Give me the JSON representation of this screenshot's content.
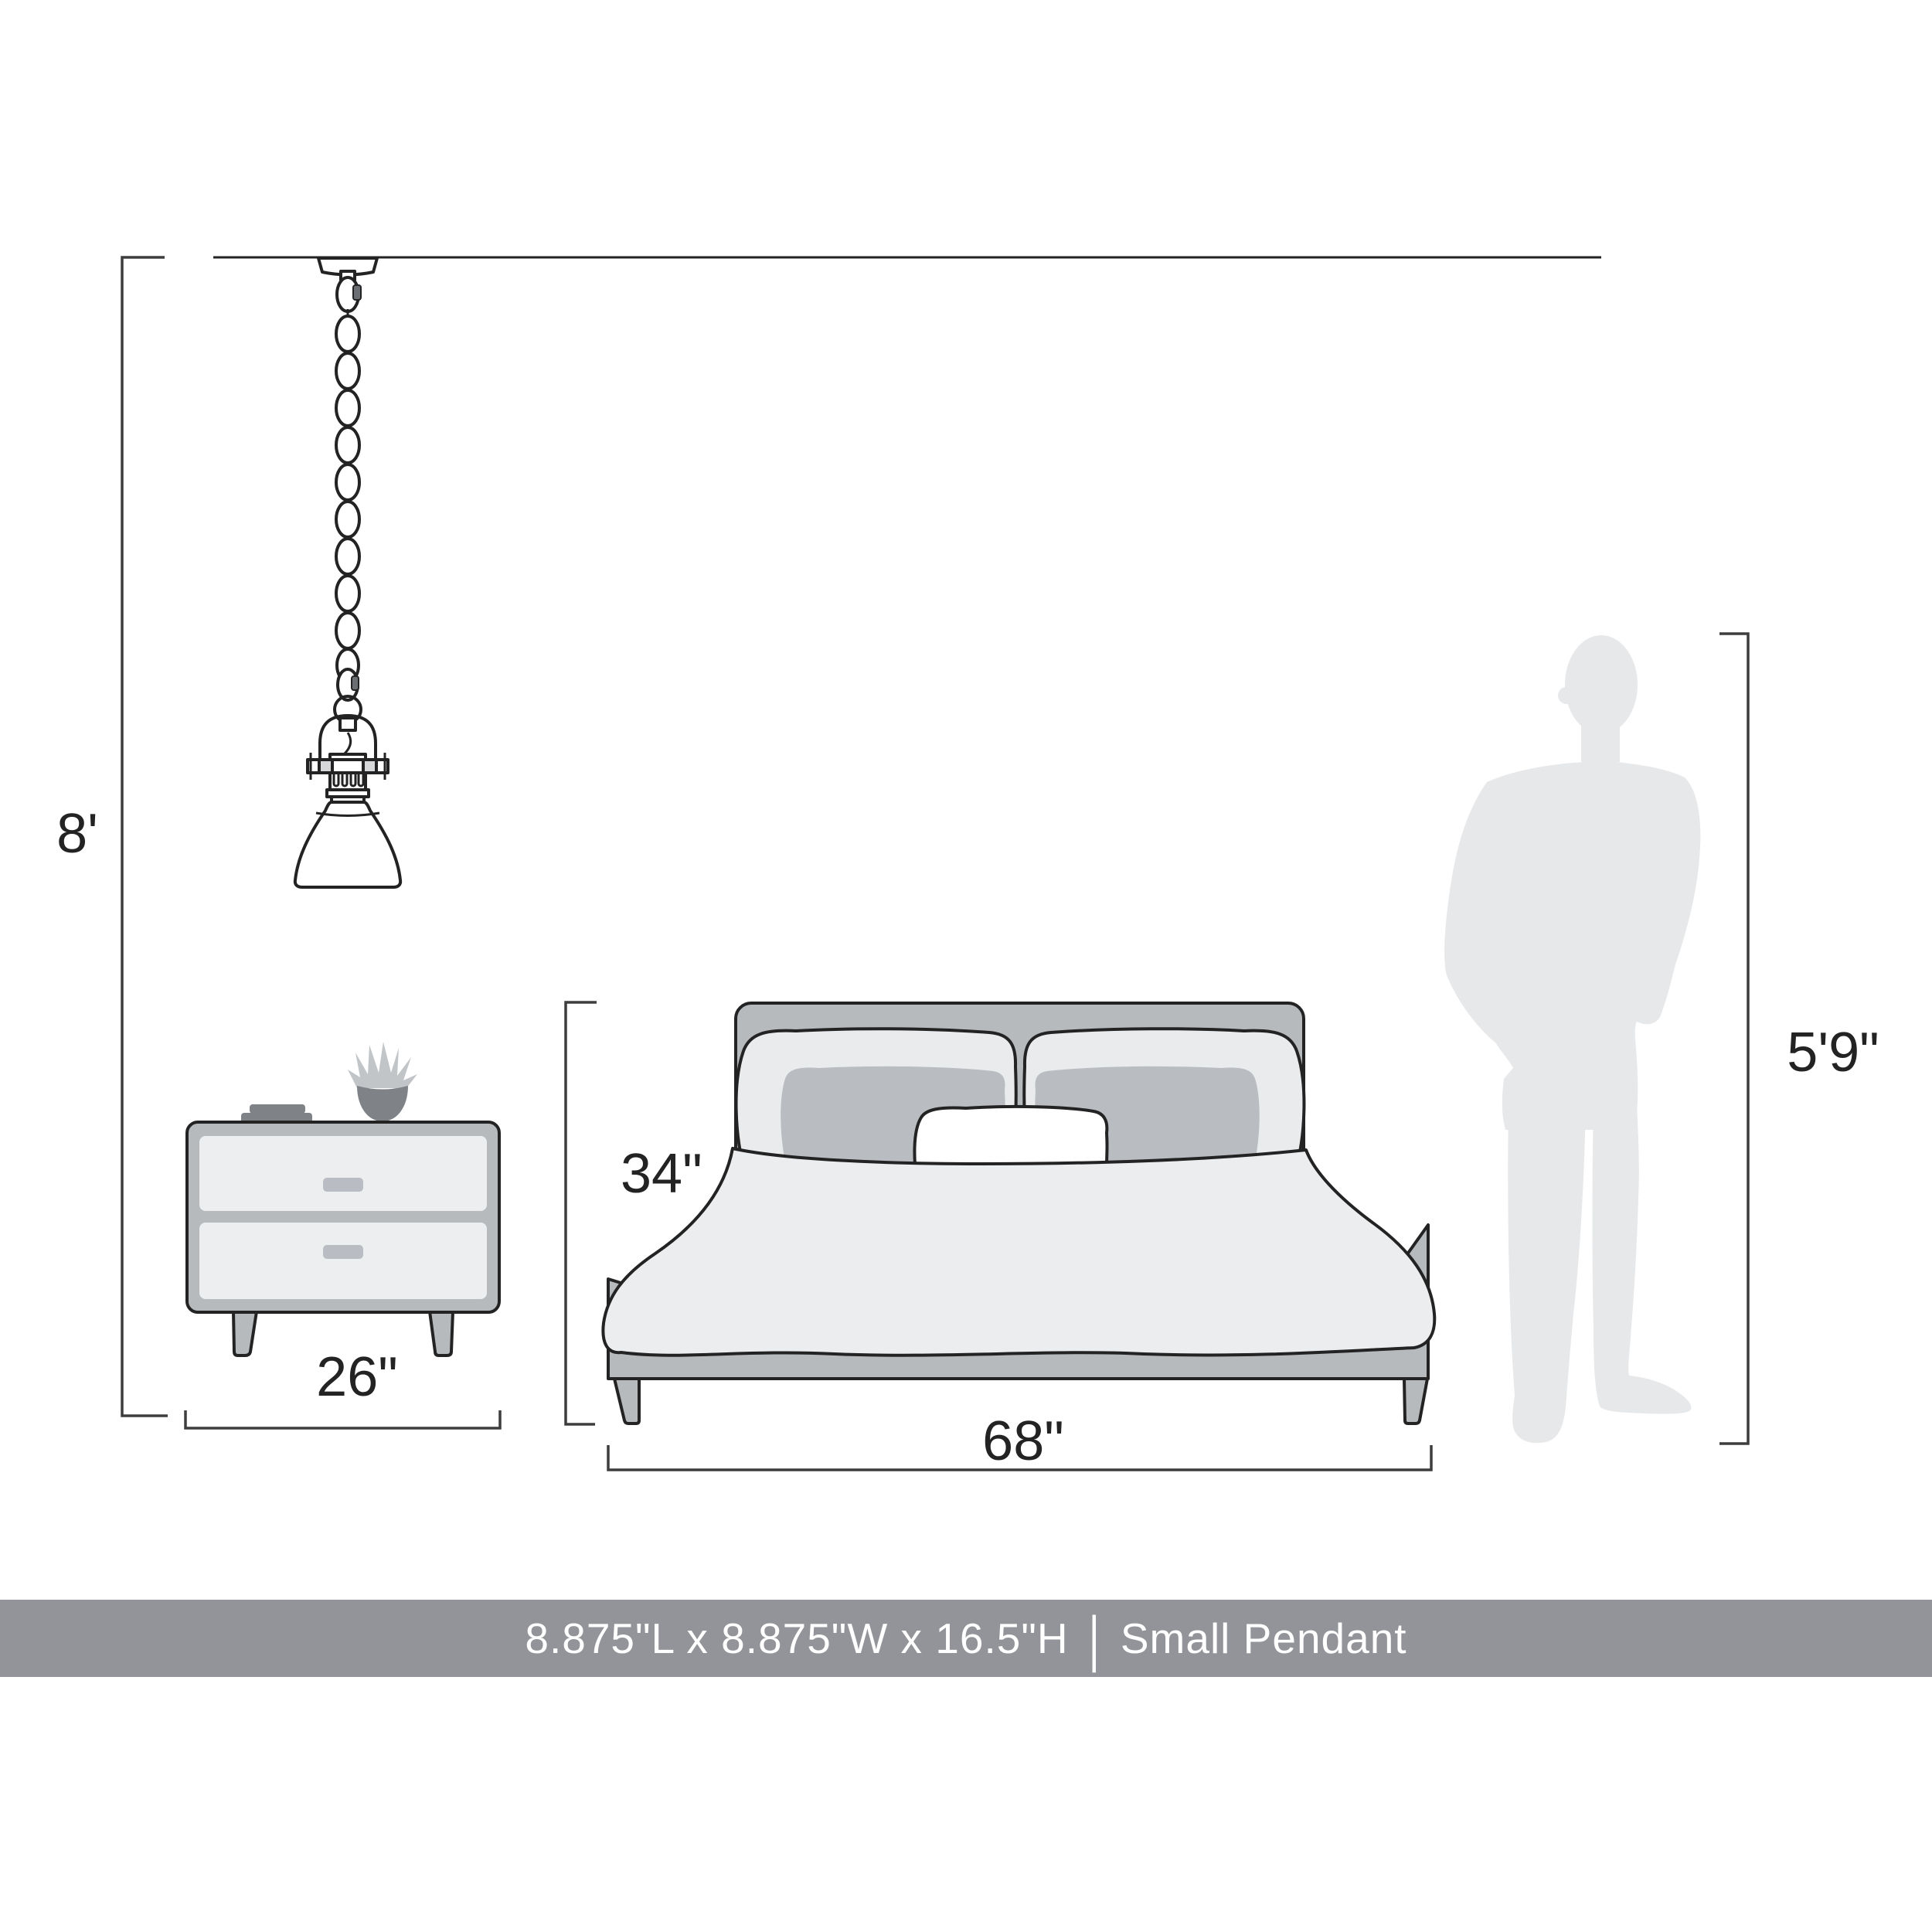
{
  "labels": {
    "ceiling_height": "8'",
    "nightstand_width": "26\"",
    "bed_height": "34\"",
    "bed_width": "68\"",
    "person_height": "5'9\""
  },
  "banner": {
    "dimensions": "8.875\"L x 8.875\"W x 16.5\"H",
    "divider": "|",
    "product_name": "Small Pendant"
  },
  "icons": {
    "pendant": "pendant-light-line-drawing",
    "nightstand": "nightstand-line-drawing",
    "bed": "bed-line-drawing",
    "person": "standing-man-silhouette"
  },
  "colors": {
    "background": "#ffffff",
    "line": "#232323",
    "dim_line": "#3d3d3d",
    "furniture_gray": "#b7babd",
    "panel_light": "#edeef0",
    "pillow_back": "#e9ebed",
    "pillow_front": "#b9bcc1",
    "pillow_center": "#ffffff",
    "duvet": "#ecedee",
    "accent_dark": "#7f8388",
    "plant_leaf": "#c2c5c8",
    "handle_gray": "#b9bcc2",
    "person": "#e7e8ea",
    "banner_bg": "#939499",
    "banner_text": "#ffffff"
  }
}
